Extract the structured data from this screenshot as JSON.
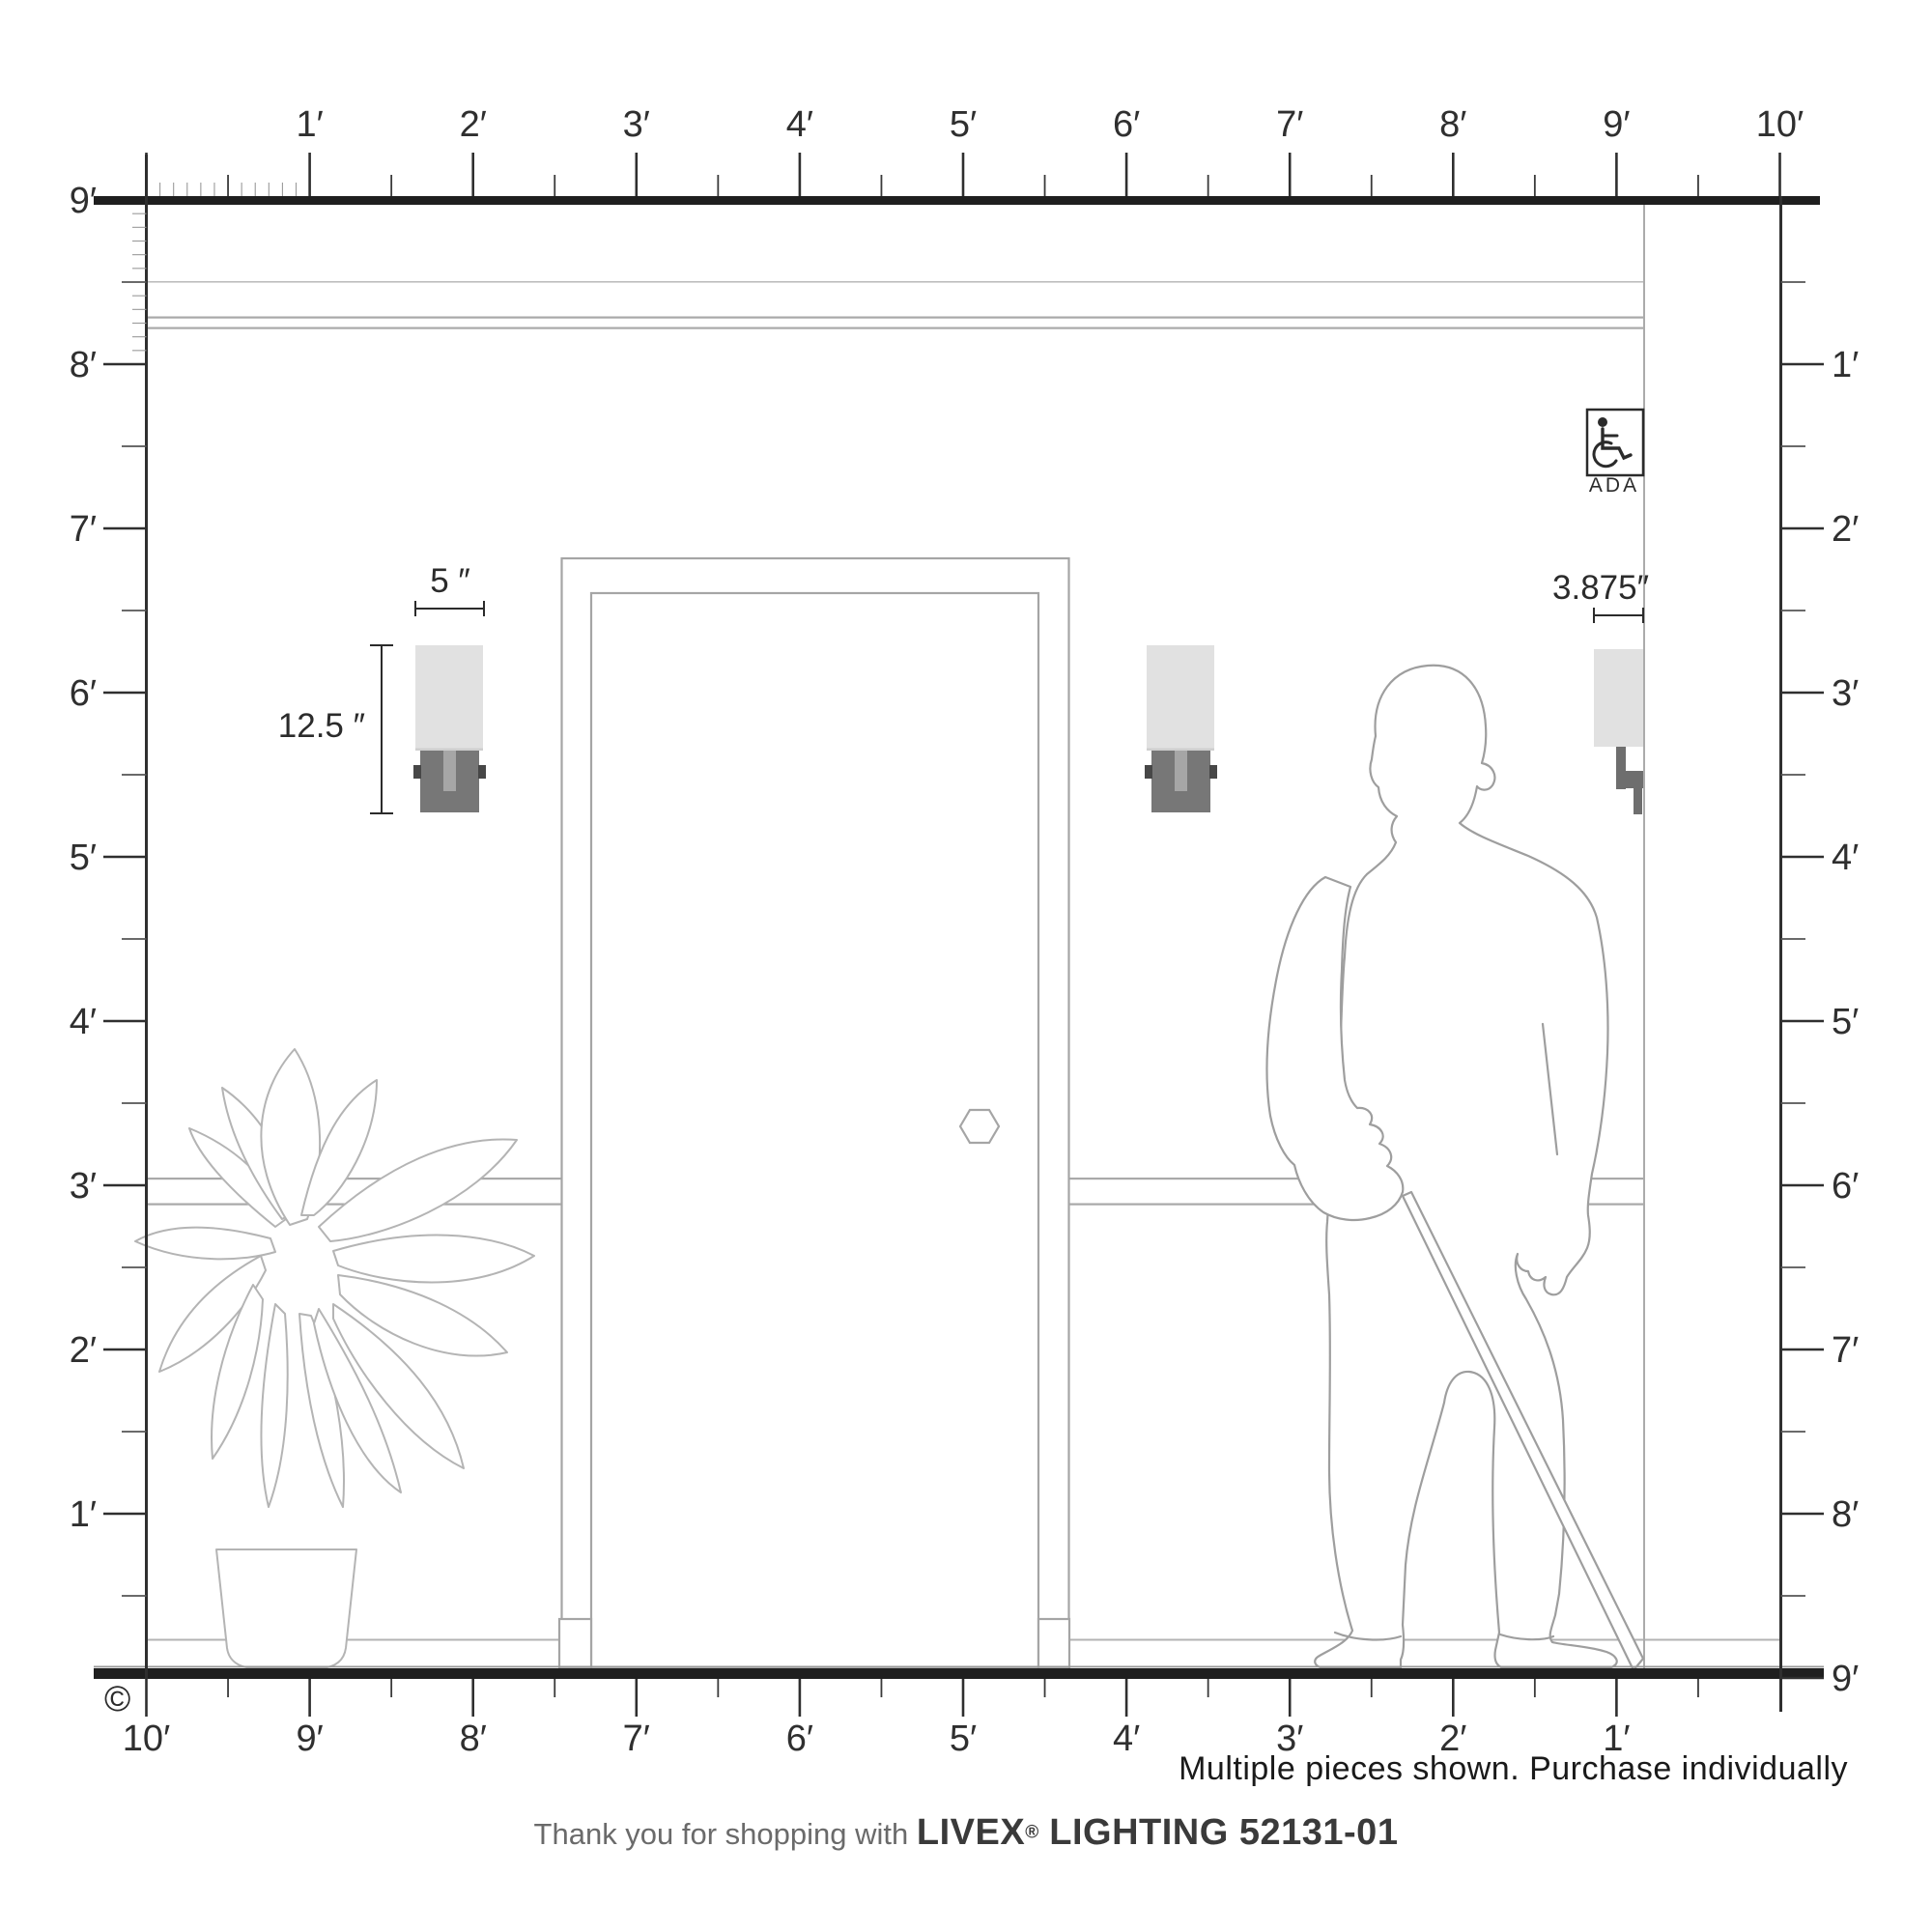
{
  "page": {
    "copyright_symbol": "©"
  },
  "rulers": {
    "top_labels": [
      "1′",
      "2′",
      "3′",
      "4′",
      "5′",
      "6′",
      "7′",
      "8′",
      "9′",
      "10′"
    ],
    "left_labels": [
      "9′",
      "8′",
      "7′",
      "6′",
      "5′",
      "4′",
      "3′",
      "2′",
      "1′"
    ],
    "right_labels": [
      "1′",
      "2′",
      "3′",
      "4′",
      "5′",
      "6′",
      "7′",
      "8′",
      "9′"
    ],
    "bottom_labels": [
      "10′",
      "9′",
      "8′",
      "7′",
      "6′",
      "5′",
      "4′",
      "3′",
      "2′",
      "1′"
    ]
  },
  "annotations": {
    "fixture_width": "5 ″",
    "fixture_height": "12.5 ″",
    "fixture_depth": "3.875″",
    "ada_label": "ADA"
  },
  "footer": {
    "note": "Multiple pieces shown. Purchase individually",
    "thanks_prefix": "Thank you for shopping with",
    "brand": "LIVEX",
    "registered": "®",
    "brand_suffix": " LIGHTING 52131-01"
  },
  "colors": {
    "ink": "#1f1f1f",
    "tick_dark": "#2f2f2f",
    "tick_light": "#9a9a9a",
    "wall_line": "#a5a5a5",
    "outline_figure": "#9e9e9e",
    "outline_plant": "#b4b4b4",
    "sconce_glass": "#e1e1e1",
    "sconce_bracket": "#777777",
    "sconce_stem": "#a6a6a6",
    "sconce_tab": "#474747",
    "sconce_side_bracket": "#6e6e6e"
  }
}
